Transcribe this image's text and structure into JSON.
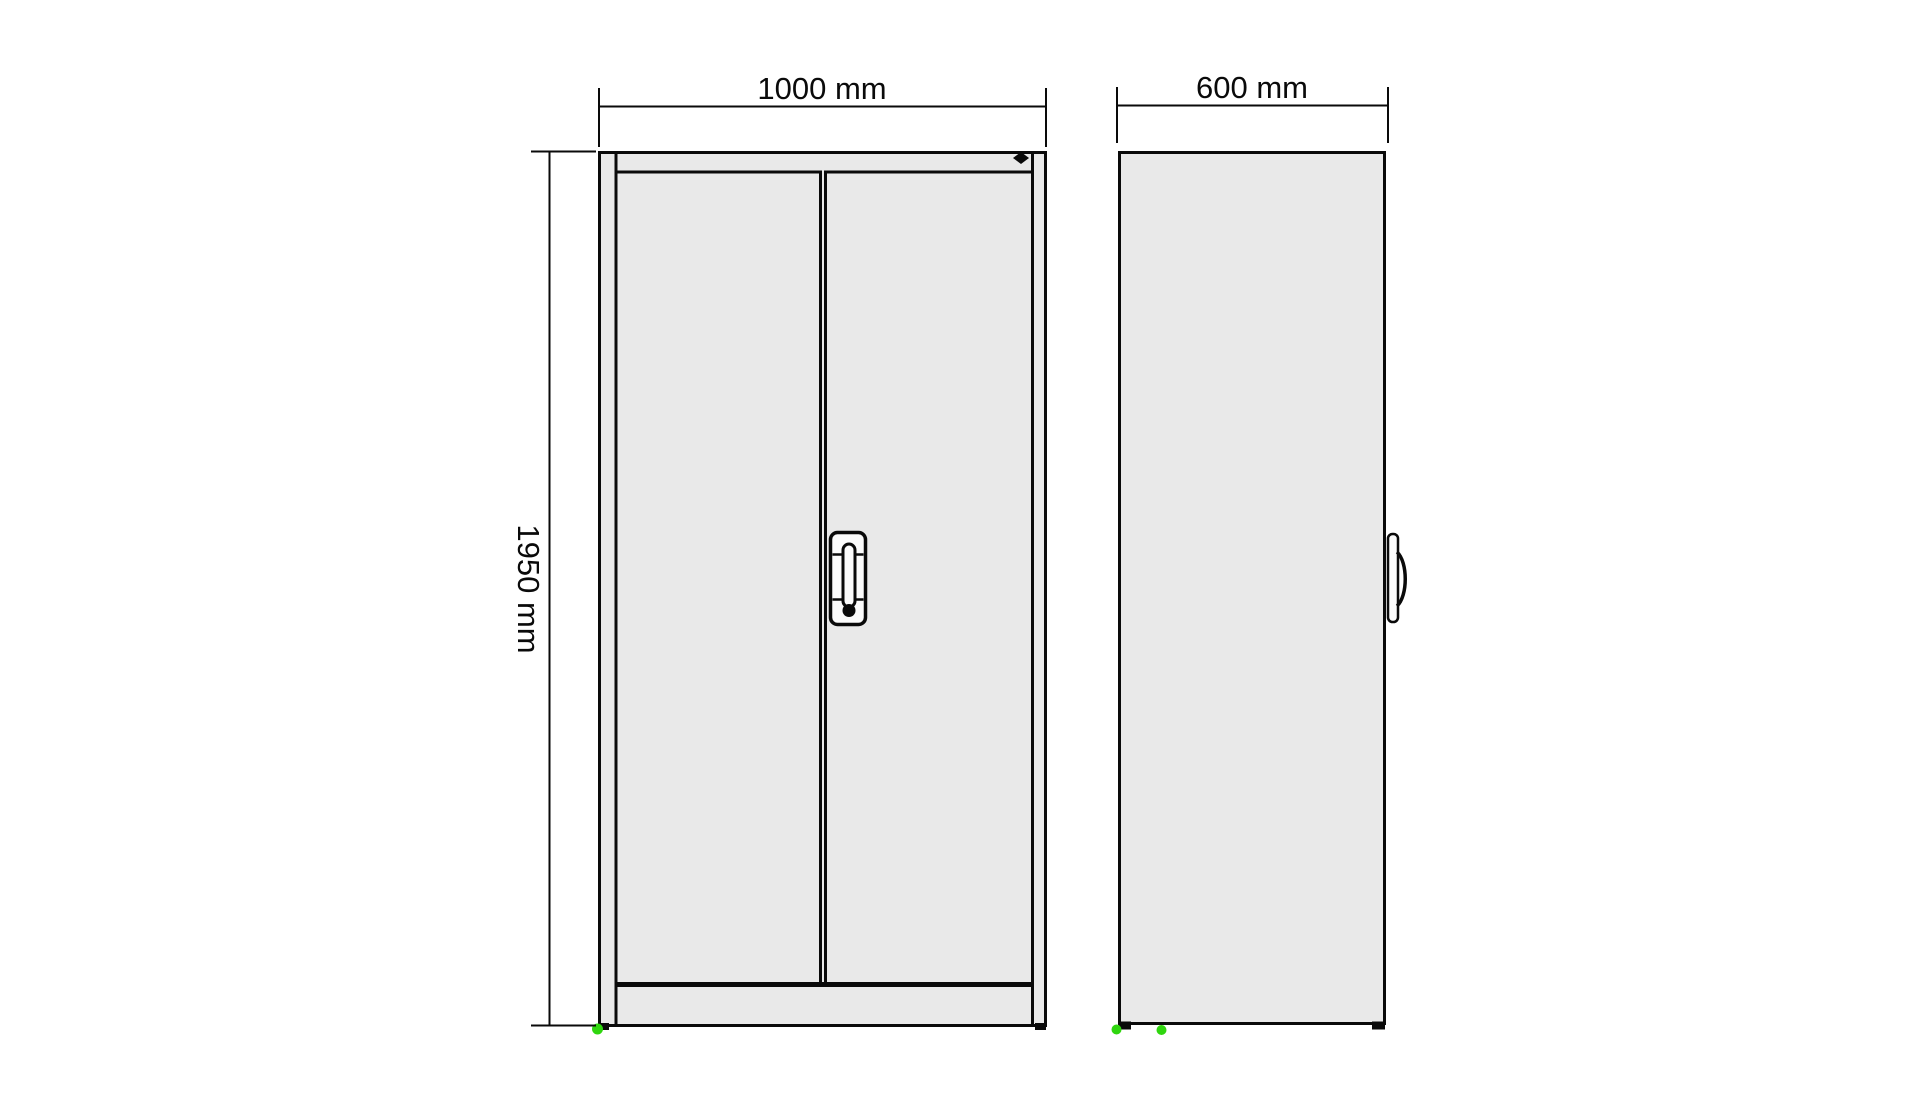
{
  "drawing": {
    "type": "cabinet-technical-drawing",
    "views": {
      "front": "front-view",
      "side": "side-view"
    }
  },
  "dimensions": {
    "front_width": "1000 mm",
    "cabinet_height": "1950 mm",
    "side_depth": "600 mm"
  },
  "icons": {
    "lock_indicator": "diamond-lock-indicator",
    "key_cylinder": "keyhole-dot"
  },
  "colors": {
    "background": "#ffffff",
    "cabinet-fill": "#e9e9e9",
    "line": "#0a0a0a",
    "handle-fill": "#fbfbfb",
    "marker-green": "#2fd60e"
  }
}
